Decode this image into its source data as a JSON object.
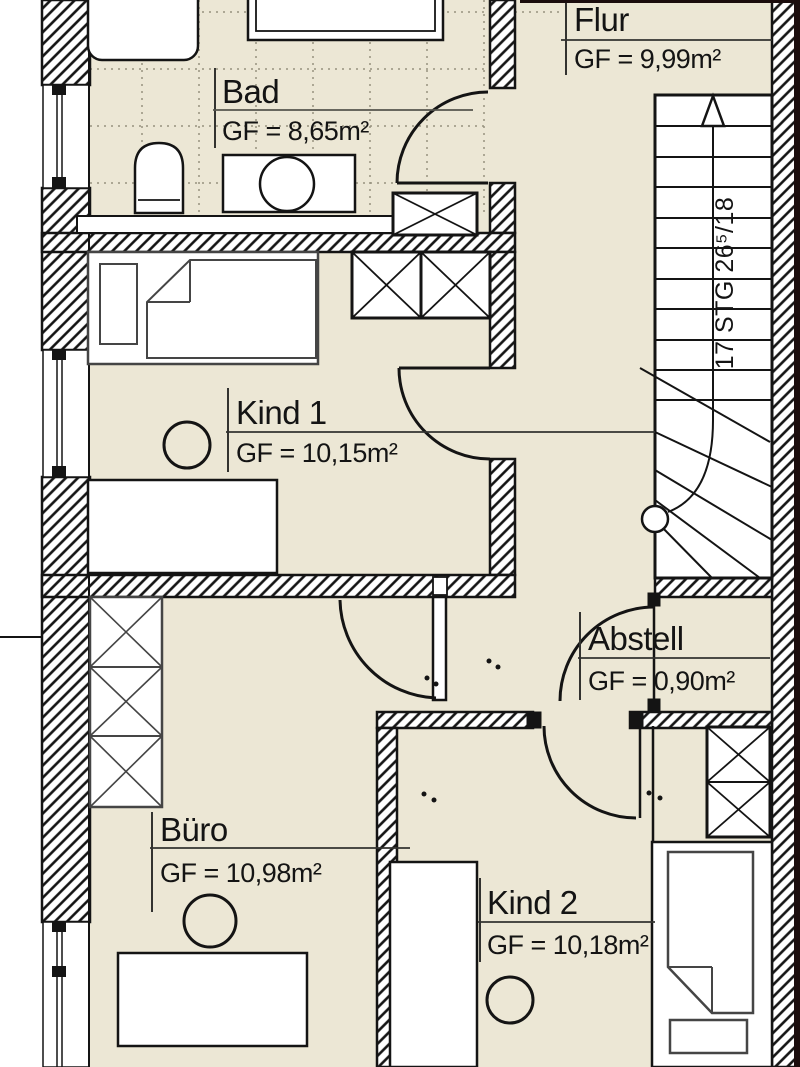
{
  "floorplan": {
    "rooms": [
      {
        "id": "flur",
        "name": "Flur",
        "area": "GF = 9,99m²"
      },
      {
        "id": "bad",
        "name": "Bad",
        "area": "GF = 8,65m²"
      },
      {
        "id": "kind1",
        "name": "Kind 1",
        "area": "GF = 10,15m²"
      },
      {
        "id": "abstell",
        "name": "Abstell",
        "area": "GF = 0,90m²"
      },
      {
        "id": "buero",
        "name": "Büro",
        "area": "GF = 10,98m²"
      },
      {
        "id": "kind2",
        "name": "Kind 2",
        "area": "GF = 10,18m²"
      }
    ],
    "stairs": {
      "label": "17 STG 26⁵/18"
    },
    "colors": {
      "floor": "#ece7d5",
      "line": "#141414",
      "tile_grid": "#96927f",
      "page_edge": "#1b0d0d"
    }
  }
}
